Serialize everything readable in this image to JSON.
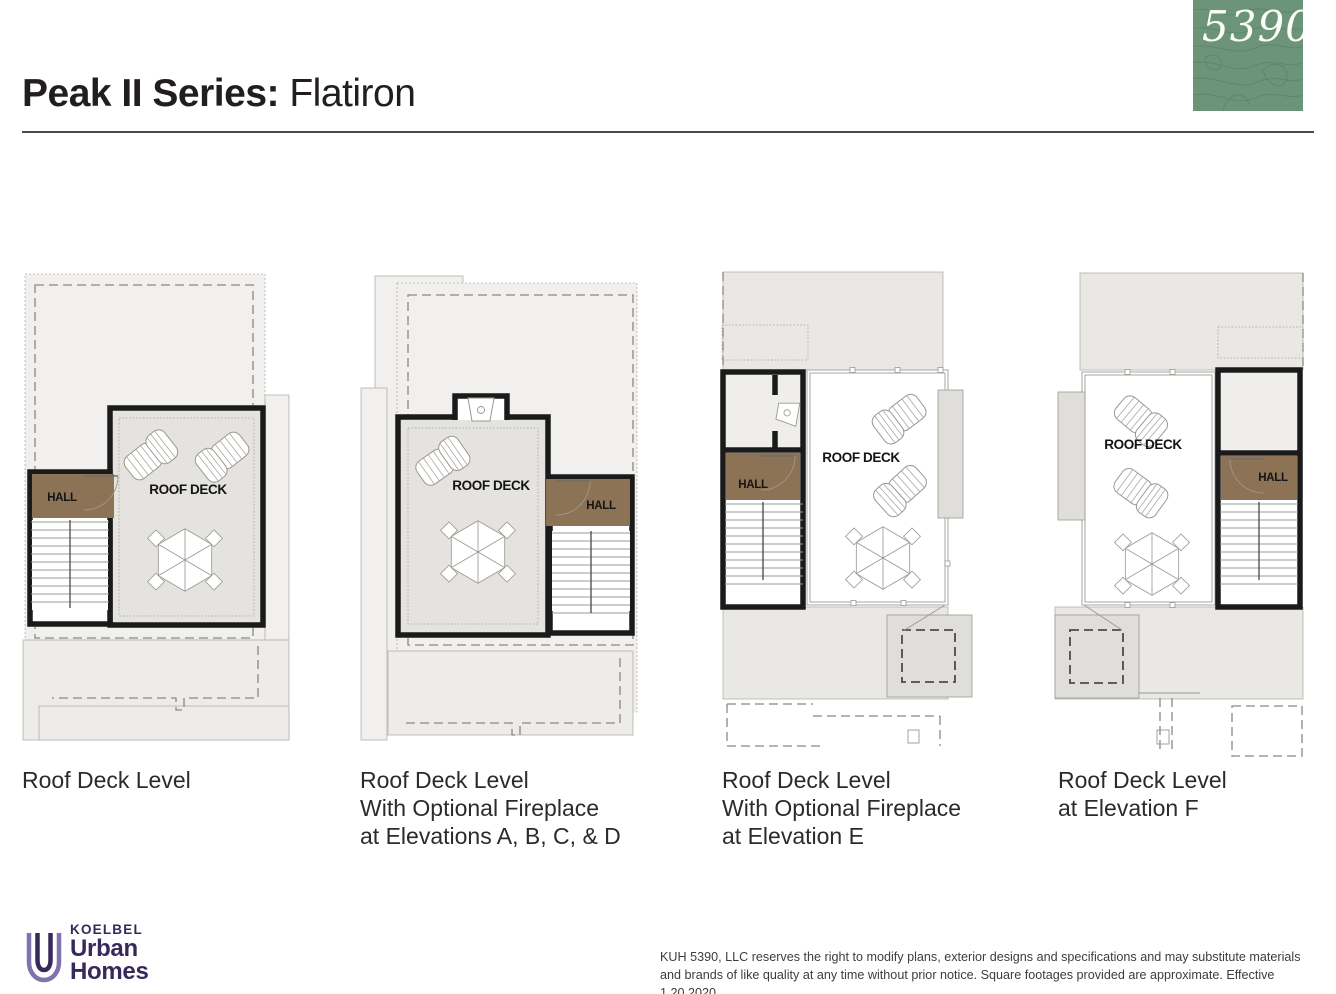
{
  "header": {
    "title_bold": "Peak II Series:",
    "title_regular": " Flatiron",
    "elevation_badge": "5390'"
  },
  "plans": [
    {
      "caption": "Roof Deck Level",
      "labels": {
        "roof_deck": "ROOF DECK",
        "hall": "HALL"
      }
    },
    {
      "caption": "Roof Deck Level\nWith Optional Fireplace\nat Elevations A, B, C, & D",
      "labels": {
        "roof_deck": "ROOF DECK",
        "hall": "HALL"
      }
    },
    {
      "caption": "Roof Deck Level\nWith Optional Fireplace\nat Elevation E",
      "labels": {
        "roof_deck": "ROOF DECK",
        "hall": "HALL"
      }
    },
    {
      "caption": "Roof Deck Level\nat Elevation F",
      "labels": {
        "roof_deck": "ROOF DECK",
        "hall": "HALL"
      }
    }
  ],
  "footer": {
    "brand_top": "KOELBEL",
    "brand_line1": "Urban",
    "brand_line2": "Homes",
    "disclaimer": "KUH 5390, LLC reserves the right to modify plans, exterior designs and specifications and may substitute materials and brands of like quality at any time without prior notice. Square footages provided are approximate. Effective 1.20.2020"
  },
  "colors": {
    "badge_green": "#6b9478",
    "hall_brown": "#8d7355",
    "brand_navy": "#38295c",
    "wall_black": "#1a1a1a"
  }
}
